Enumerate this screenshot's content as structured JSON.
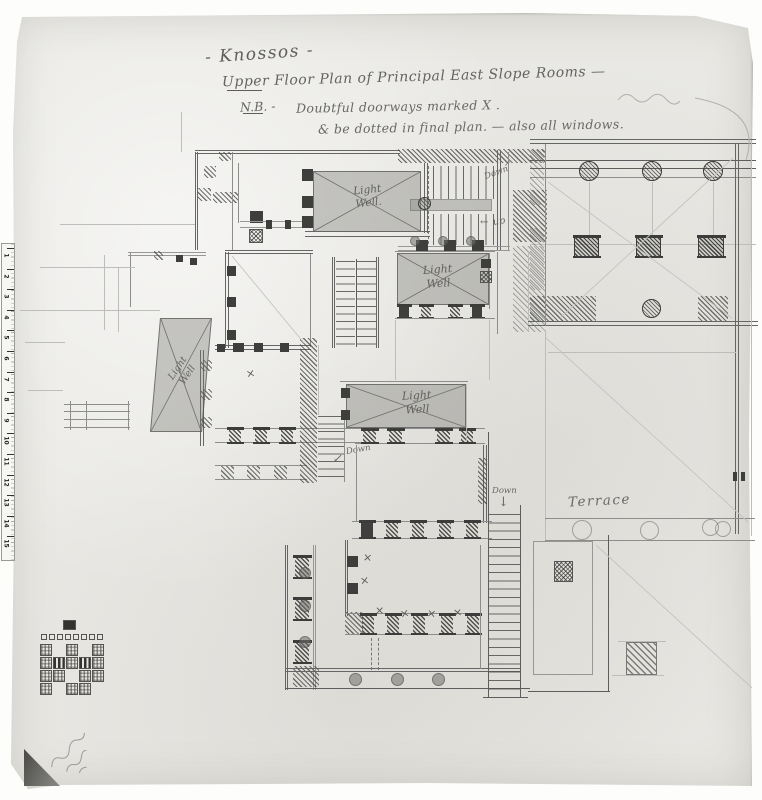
{
  "title": {
    "heading": "- Knossos -",
    "subheading": "Upper Floor Plan of Principal East Slope Rooms —",
    "nb_label": "N.B. -",
    "nb_text": "Doubtful doorways marked X .",
    "nb_text2": "& be dotted in final plan. — also all windows."
  },
  "labels": {
    "light_well_1": "Light\nWell.",
    "light_well_2": "Light\nWell",
    "light_well_3": "Light\nWell",
    "light_well_4": "Light\nWell",
    "terrace": "Terrace"
  },
  "annotations": {
    "down_top": "Down",
    "up": "up",
    "down_mid": "Down",
    "down_stair": "Down",
    "x_mark": "×",
    "arrow_down": "↓",
    "arrow_left": "←",
    "arrow_down_left": "↙",
    "arrow_up_right": "↗"
  },
  "ruler": {
    "numbers": [
      "1",
      "2",
      "3",
      "4",
      "5",
      "6",
      "7",
      "8",
      "9",
      "10",
      "11",
      "12",
      "13",
      "14",
      "15"
    ]
  },
  "sketch": {
    "top_cells": 8,
    "pattern_rows": [
      "c.c.c",
      "cdcdc",
      "cc.cc",
      "c.cc."
    ]
  },
  "colors": {
    "paper": "#e9e8e4",
    "pencil_dark": "#3e3e3c",
    "pencil_mid": "#5d5d5d",
    "pencil_faint": "#8d8d8d",
    "light_well_wash": "rgba(122,120,116,0.38)"
  }
}
